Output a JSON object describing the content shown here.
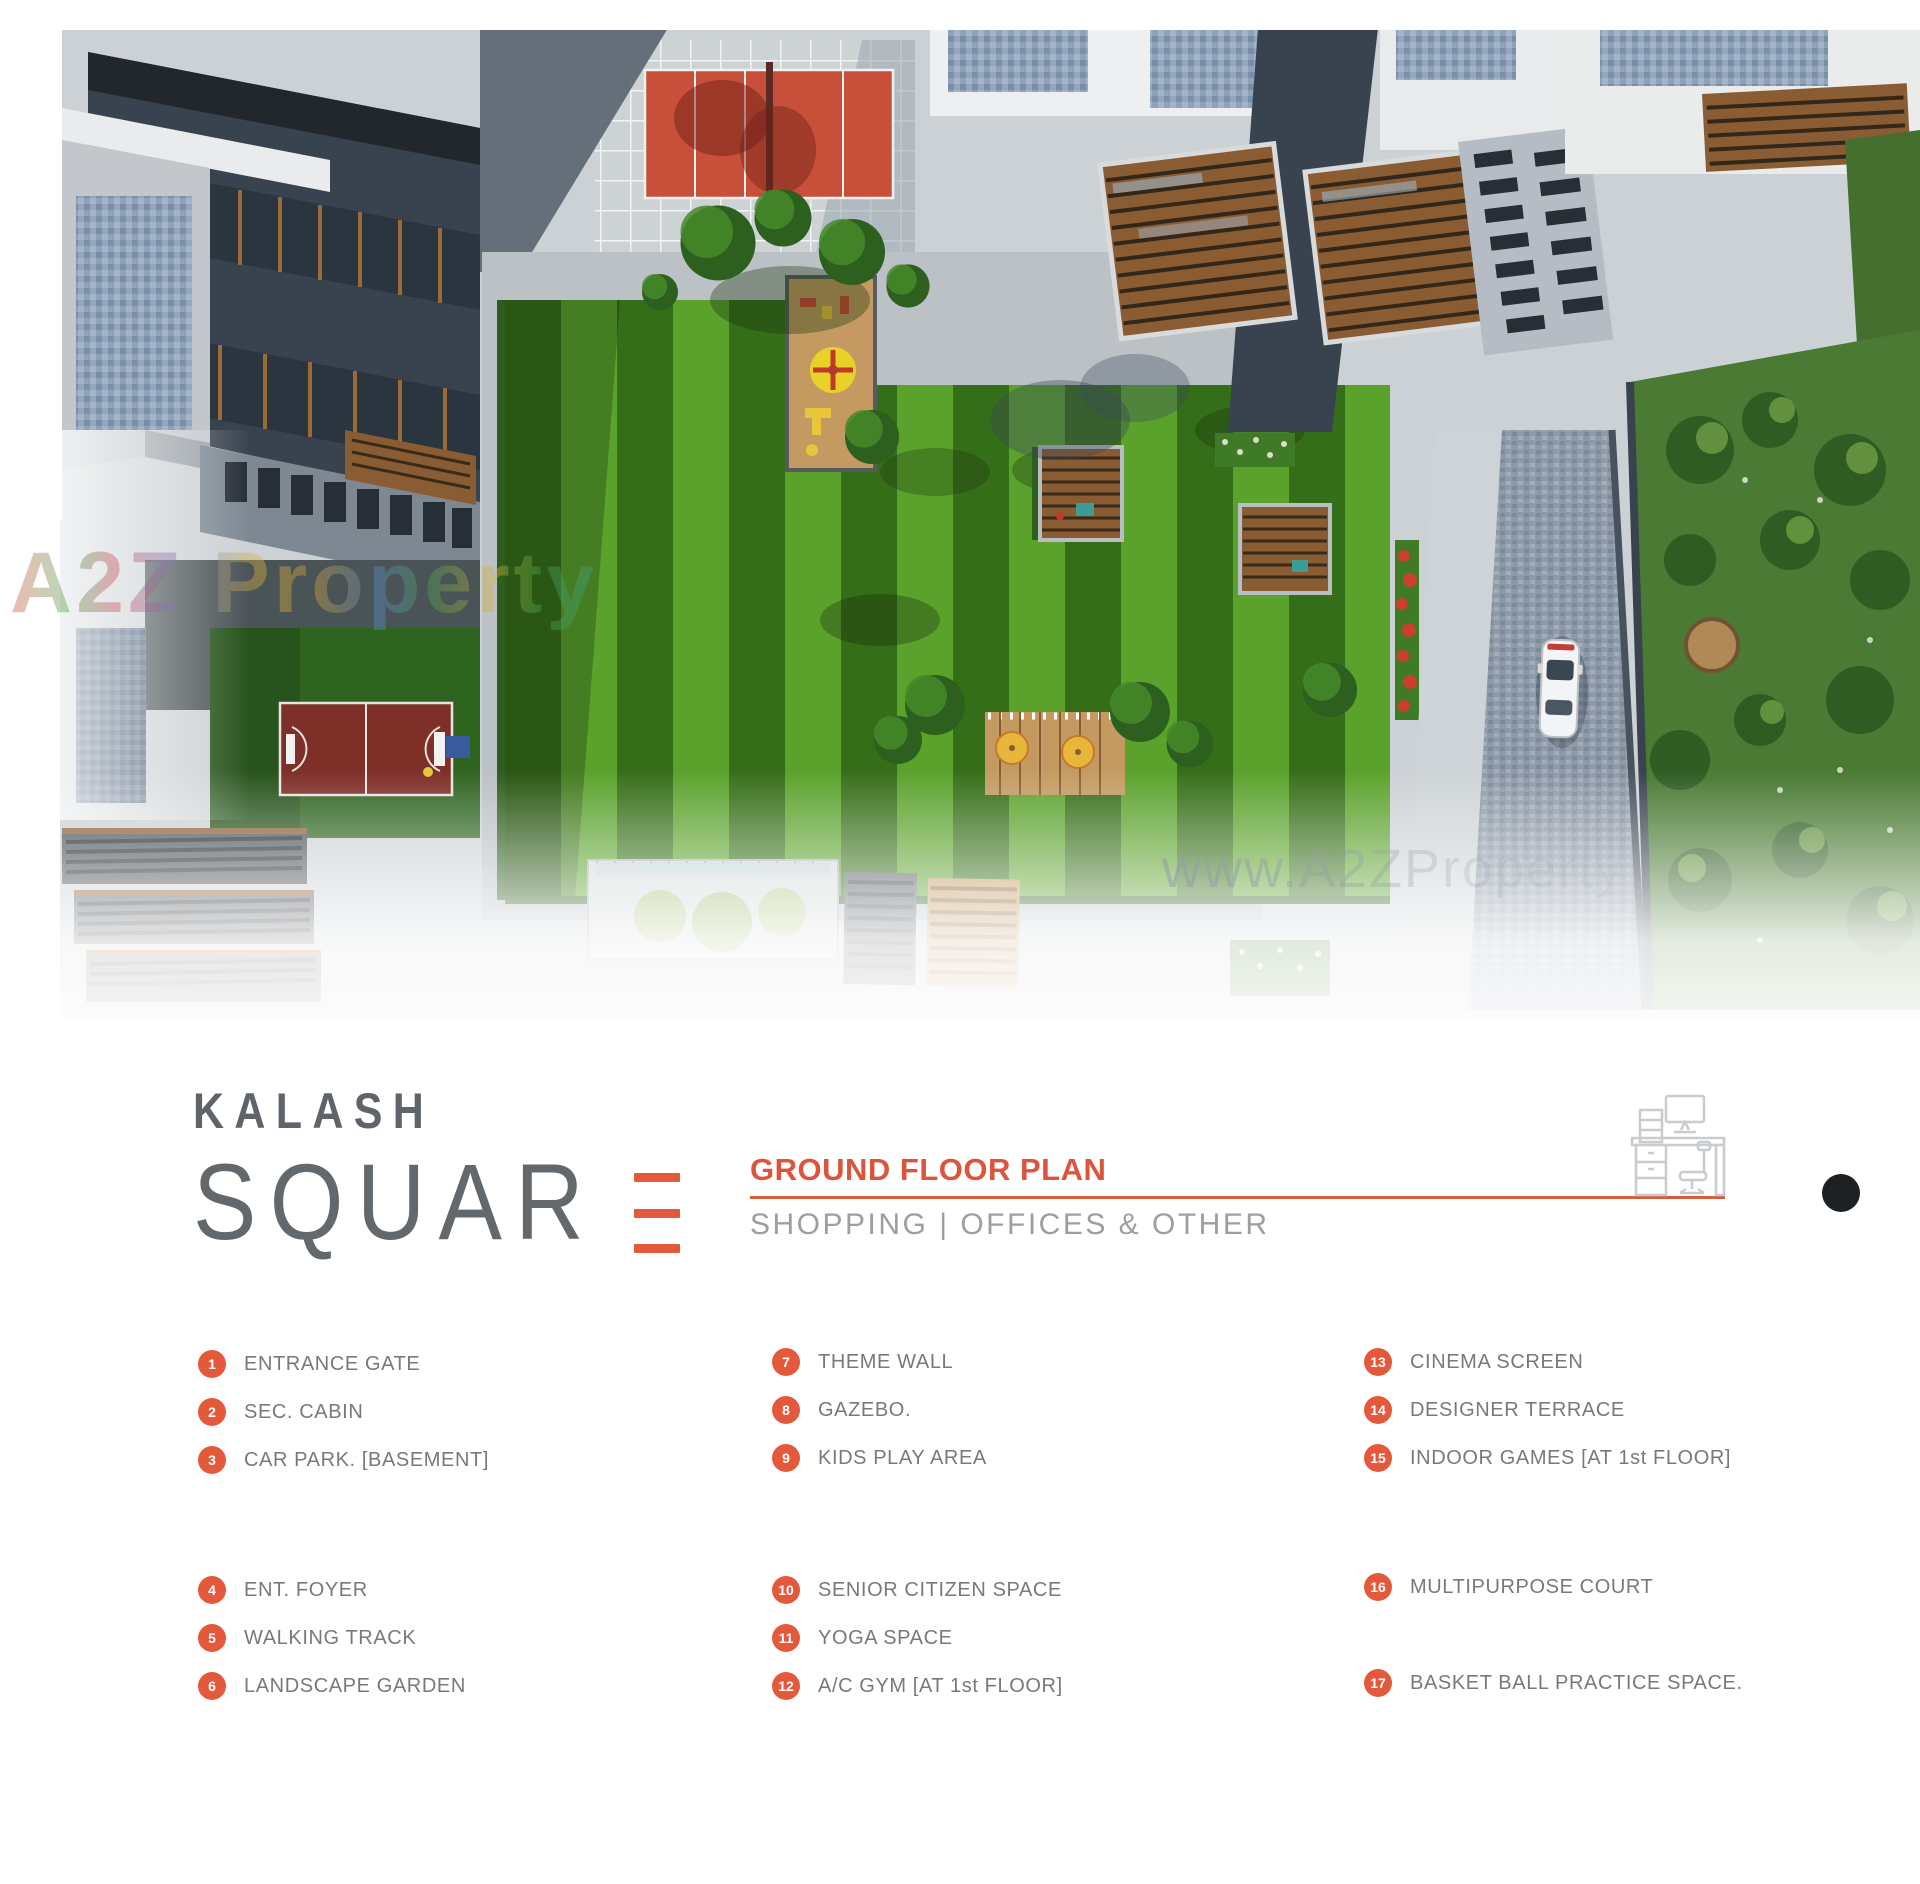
{
  "brand": {
    "word1": "KALASH",
    "word2": "SQUAR",
    "word2_last_letter": "E"
  },
  "header": {
    "title": "GROUND FLOOR PLAN",
    "subtitle": "SHOPPING | OFFICES & OTHER"
  },
  "watermarks": {
    "corner": "A2Z Property",
    "center": "www.A2ZProperty"
  },
  "legend": {
    "items": [
      {
        "num": "1",
        "label": "ENTRANCE GATE"
      },
      {
        "num": "2",
        "label": "SEC. CABIN"
      },
      {
        "num": "3",
        "label": "CAR PARK. [BASEMENT]"
      },
      {
        "num": "4",
        "label": "ENT. FOYER"
      },
      {
        "num": "5",
        "label": "WALKING TRACK"
      },
      {
        "num": "6",
        "label": "LANDSCAPE GARDEN"
      },
      {
        "num": "7",
        "label": "THEME WALL"
      },
      {
        "num": "8",
        "label": "GAZEBO."
      },
      {
        "num": "9",
        "label": "KIDS PLAY AREA"
      },
      {
        "num": "10",
        "label": "SENIOR CITIZEN SPACE"
      },
      {
        "num": "11",
        "label": "YOGA SPACE"
      },
      {
        "num": "12",
        "label": "A/C GYM [AT 1st FLOOR]"
      },
      {
        "num": "13",
        "label": "CINEMA SCREEN"
      },
      {
        "num": "14",
        "label": "DESIGNER TERRACE"
      },
      {
        "num": "15",
        "label": "INDOOR GAMES [AT 1st FLOOR]"
      },
      {
        "num": "16",
        "label": "MULTIPURPOSE COURT"
      },
      {
        "num": "17",
        "label": "BASKET BALL PRACTICE SPACE."
      }
    ]
  },
  "colors": {
    "accent_orange": "#e4593b",
    "heading_orange": "#dc543c",
    "logo_grey": "#5f646a",
    "legend_text_grey": "#77797b",
    "lawn_light": "#5ba22c",
    "lawn_dark": "#356e18",
    "court_red": "#c8503a",
    "basketball_court_maroon": "#7e2f28",
    "pavement_grey": "#ccd1d5",
    "wood_brown": "#8a5c33",
    "punch_dot_black": "#1e2124"
  }
}
